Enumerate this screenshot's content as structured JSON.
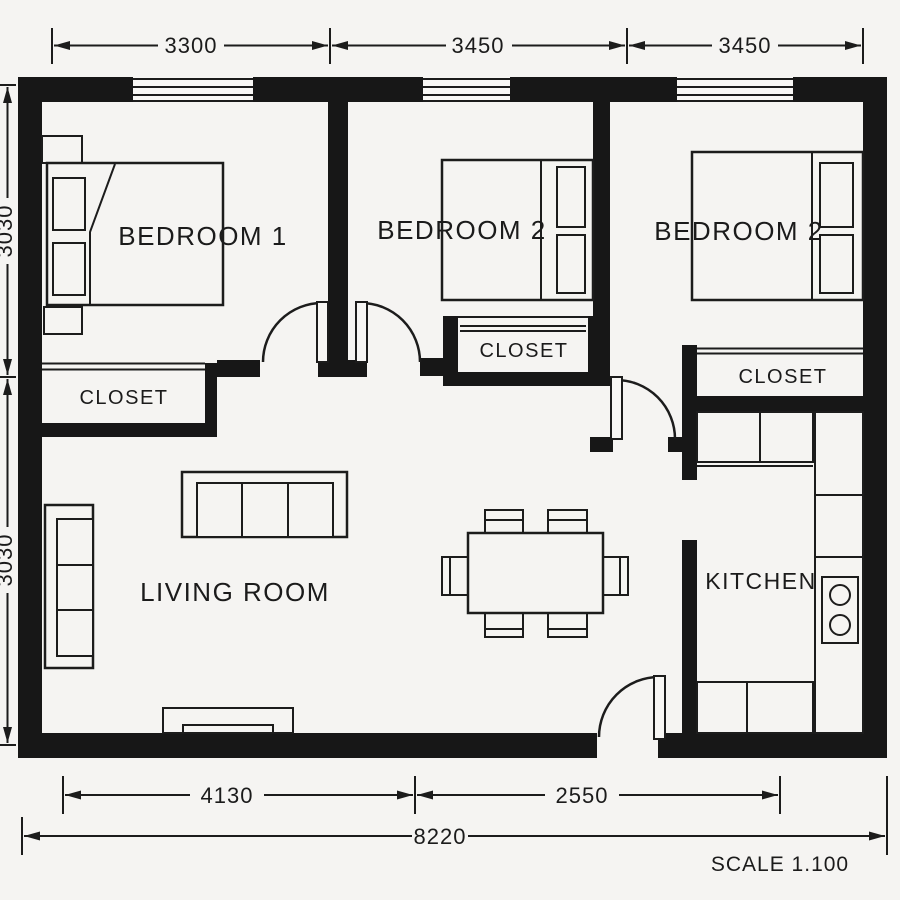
{
  "rooms": {
    "bedroom1": "BEDROOM 1",
    "bedroom2": "BEDROOM 2",
    "bedroom3": "BEDROOM 2",
    "living": "LIVING ROOM",
    "kitchen": "KITCHEN",
    "closet1": "CLOSET",
    "closet2": "CLOSET",
    "closet3": "CLOSET"
  },
  "dimensions": {
    "top": {
      "seg1": "3300",
      "seg2": "3450",
      "seg3": "3450"
    },
    "left": {
      "seg1": "3030",
      "seg2": "3030"
    },
    "bottom": {
      "seg1": "4130",
      "seg2": "2550",
      "total": "8220"
    },
    "scale": "SCALE 1.100"
  },
  "colors": {
    "wall": "#171717",
    "background": "#f5f4f2",
    "line": "#1c1c1c"
  }
}
